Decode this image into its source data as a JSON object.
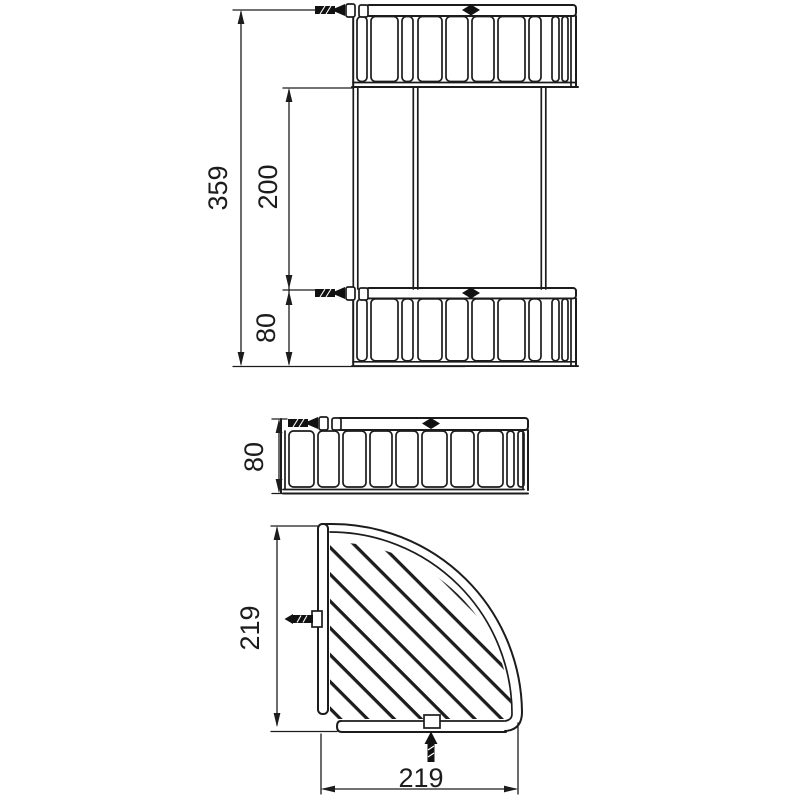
{
  "drawing": {
    "colors": {
      "line": "#1c1c1c",
      "ink": "#111111",
      "background": "#ffffff"
    },
    "front_view": {
      "total_height": "359",
      "tier_spacing": "200",
      "tier_height": "80"
    },
    "side_view": {
      "tier_height": "80"
    },
    "plan_view": {
      "depth": "219",
      "width": "219"
    }
  }
}
